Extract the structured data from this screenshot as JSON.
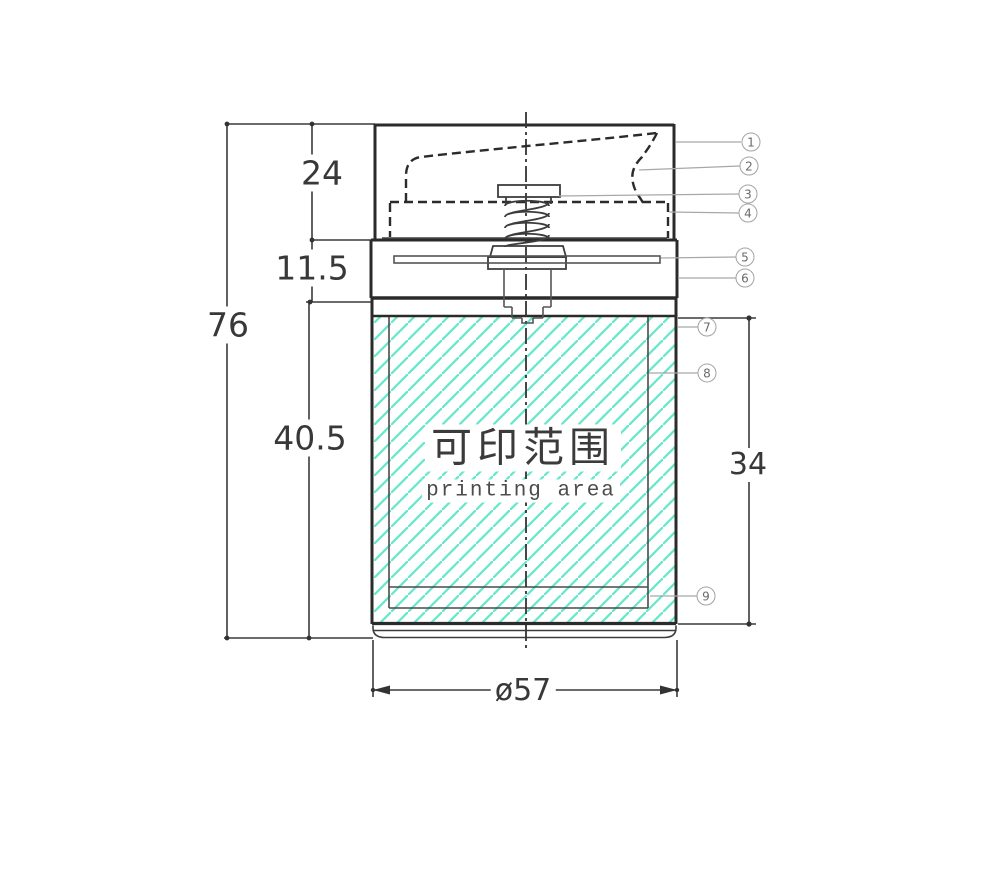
{
  "figure": {
    "type": "engineering-drawing",
    "dimensions": {
      "cap_height": "24",
      "pump_section_height": "11.5",
      "overall_height": "76",
      "body_height": "40.5",
      "print_height": "34",
      "diameter": "ø57"
    },
    "printing_area": {
      "label_cn": "可印范围",
      "label_en": "printing area"
    },
    "callouts": [
      {
        "label": "1"
      },
      {
        "label": "2"
      },
      {
        "label": "3"
      },
      {
        "label": "4"
      },
      {
        "label": "5"
      },
      {
        "label": "6"
      },
      {
        "label": "7"
      },
      {
        "label": "8"
      },
      {
        "label": "9"
      }
    ],
    "colors": {
      "hatch": "#69e7cb",
      "line": "#2b2b2b",
      "callout_stroke": "#a3a3a3",
      "text": "#383838"
    }
  }
}
